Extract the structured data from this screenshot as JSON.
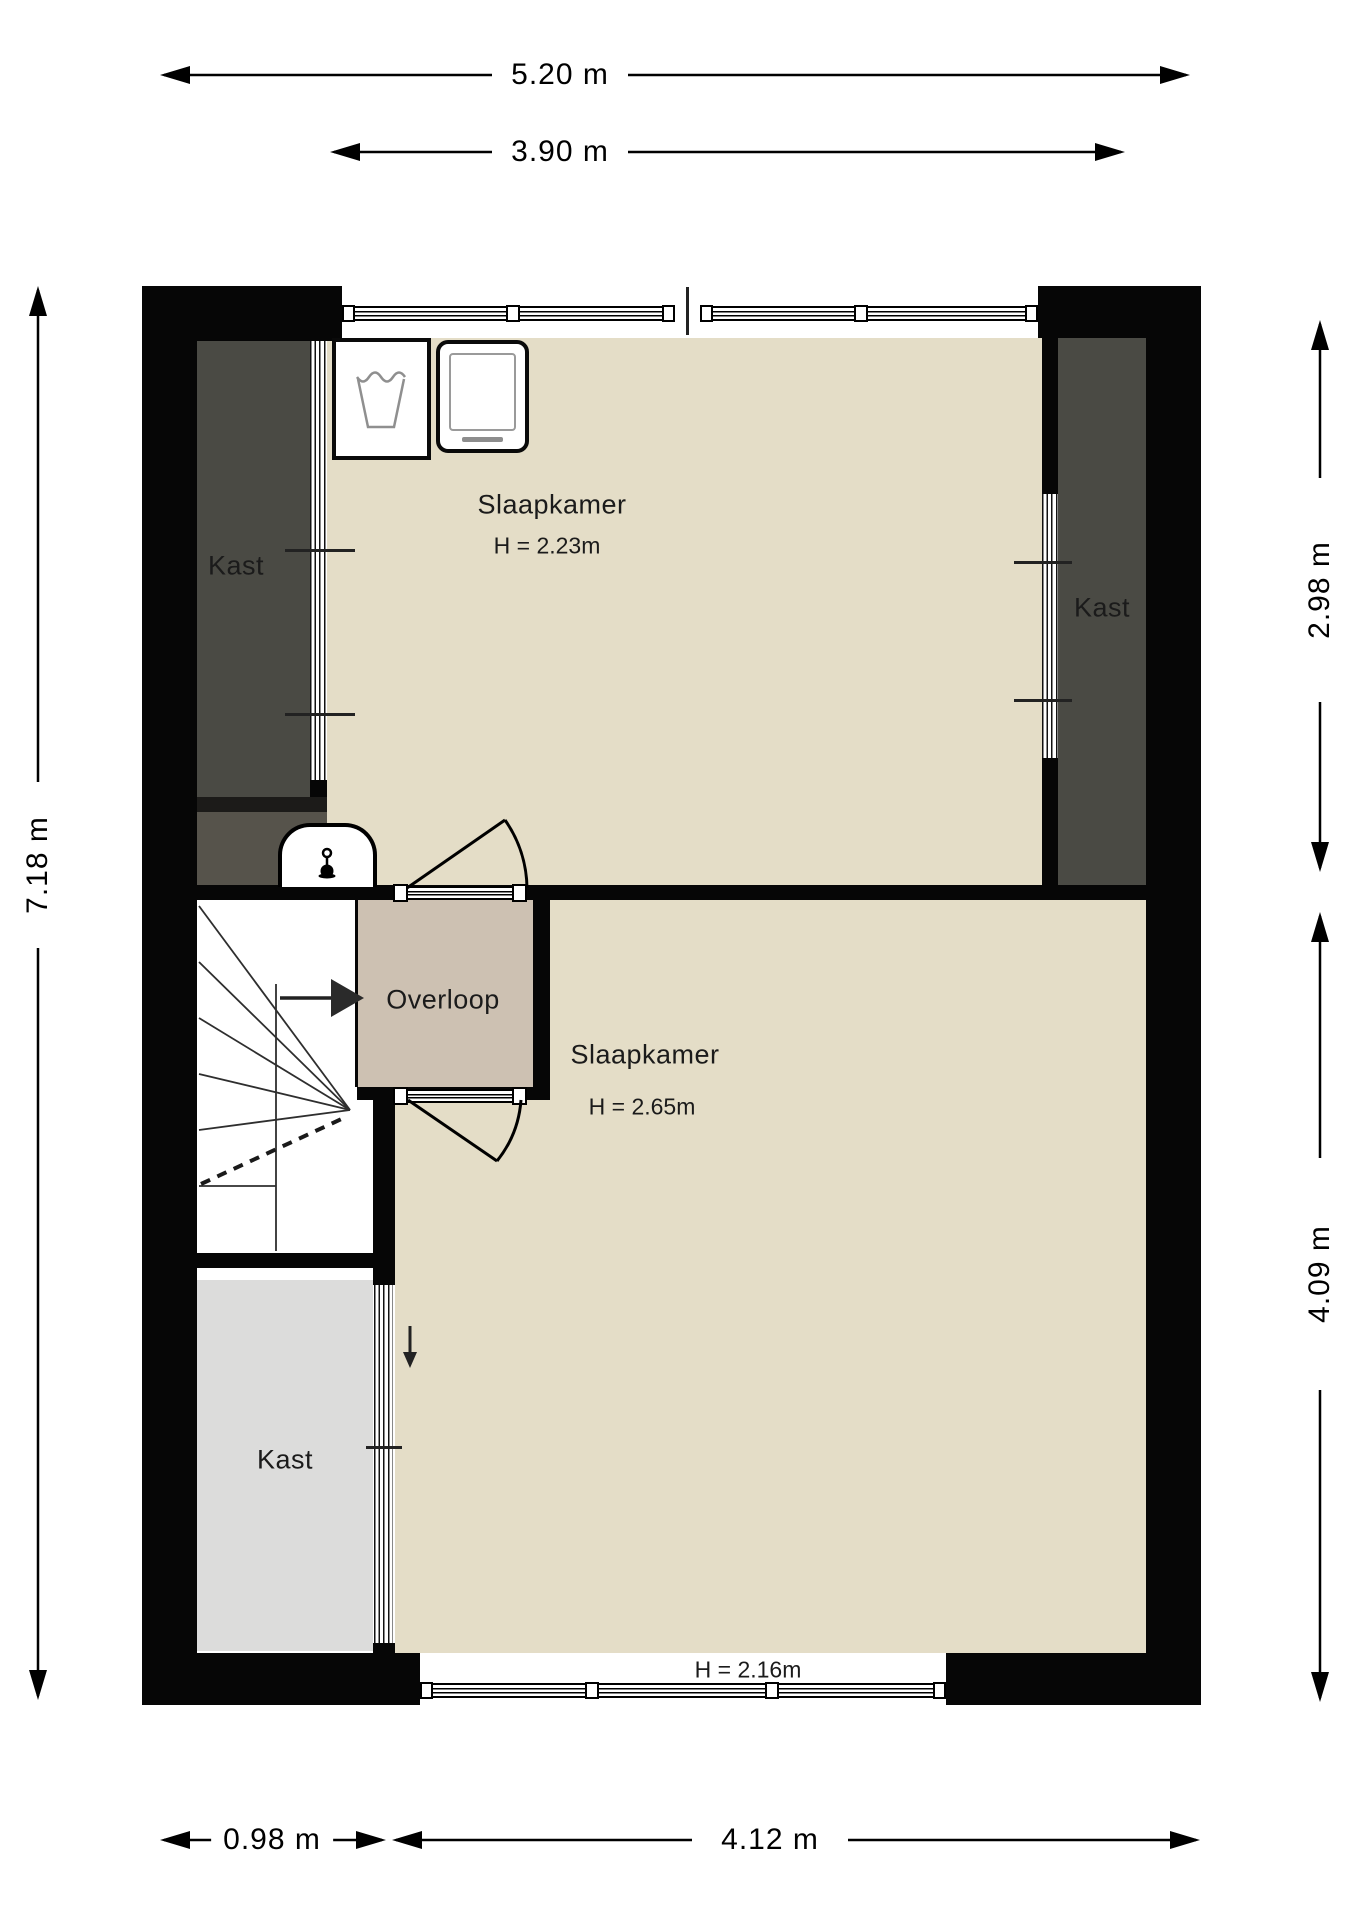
{
  "floorplan": {
    "type": "floor-plan",
    "floor": "upper floor (bedrooms level)",
    "dimensions": {
      "top_outer": "5.20 m",
      "top_inner": "3.90 m",
      "left": "7.18 m",
      "right_upper": "2.98 m",
      "right_lower": "4.09 m",
      "bottom_left": "0.98 m",
      "bottom_right": "4.12 m"
    },
    "rooms": {
      "bedroom1": {
        "name": "Slaapkamer",
        "ceiling_height": "H = 2.23m"
      },
      "bedroom2": {
        "name": "Slaapkamer",
        "ceiling_height": "H = 2.65m",
        "window_height_marker": "H = 2.16m"
      },
      "landing": {
        "name": "Overloop"
      },
      "closet_top_left": {
        "name": "Kast"
      },
      "closet_right": {
        "name": "Kast"
      },
      "closet_bottom_left": {
        "name": "Kast"
      }
    },
    "icons": {
      "washing_machine": "washing-machine-icon",
      "dryer": "dryer-icon",
      "boiler_niche": "thermometer-icon",
      "stairs": "winder-stairs with direction arrow",
      "slope_arrow": "down-arrow"
    },
    "colors": {
      "wall": "#060606",
      "bedroom_floor": "#e4ddc7",
      "landing_floor": "#cdc1b2",
      "closet_dark": "#4a4a44",
      "closet_light": "#dcdcdb",
      "meter_area": "#56534b"
    }
  }
}
